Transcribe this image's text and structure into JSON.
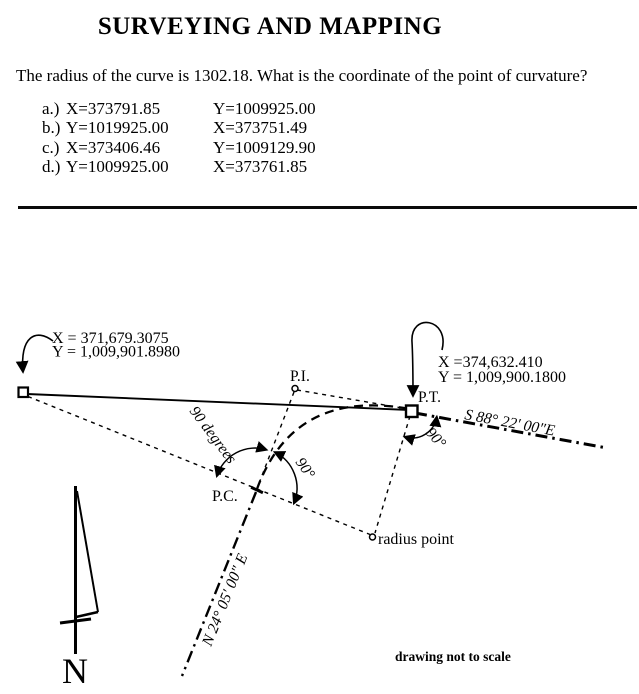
{
  "title": "SURVEYING AND MAPPING",
  "question": "The radius of the curve is 1302.18. What is the coordinate of the point of curvature?",
  "options": [
    {
      "label": "a.)",
      "col1": "X=373791.85",
      "col2": "Y=1009925.00"
    },
    {
      "label": "b.)",
      "col1": "Y=1019925.00",
      "col2": "X=373751.49"
    },
    {
      "label": "c.)",
      "col1": "X=373406.46",
      "col2": "Y=1009129.90"
    },
    {
      "label": "d.)",
      "col1": "Y=1009925.00",
      "col2": "X=373761.85"
    }
  ],
  "diagram": {
    "point_a": {
      "x_label": "X = 371,679.3075",
      "y_label": "Y = 1,009,901.8980"
    },
    "point_pt": {
      "name": "P.T.",
      "x_label": "X =374,632.410",
      "y_label": "Y = 1,009,900.1800"
    },
    "point_pi": {
      "name": "P.I."
    },
    "point_pc": {
      "name": "P.C."
    },
    "radius_point_label": "radius point",
    "bearing_back": "N 24° 05' 00\" E",
    "bearing_forward": "S 88° 22' 00\"E",
    "angle_pc_left": "90 degrees",
    "angle_pc_right": "90°",
    "angle_pt": "90°",
    "north_label": "N",
    "scale_note": "drawing not to scale",
    "ink_color": "#000000",
    "background": "#ffffff"
  }
}
